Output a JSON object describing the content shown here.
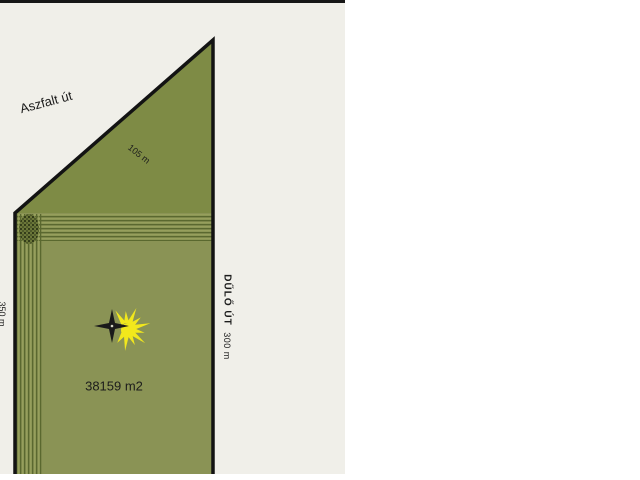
{
  "canvas": {
    "description": "cadastral parcel sketch",
    "width": 640,
    "height": 480
  },
  "colors": {
    "page_bg": "#ffffff",
    "canvas_bg": "#f0efe9",
    "parcel_fill": "#8a9355",
    "triangle_fill": "#7e8b45",
    "stipple_base": "#6b7739",
    "border": "#131313",
    "sun_yellow": "#f2e81c",
    "star_black": "#1a1a1a",
    "text": "#1c1c1c"
  },
  "labels": {
    "road_top": "Aszfalt út",
    "edge_diagonal": "105 m",
    "edge_left": "350 m",
    "road_right": "DŰLŐ ÚT",
    "edge_right": "300 m",
    "area": "38159 m2"
  },
  "symbols": {
    "sun": "sun-burst-symbol",
    "star": "four-point-star-symbol",
    "stipple": "stipple-corner-marker"
  }
}
